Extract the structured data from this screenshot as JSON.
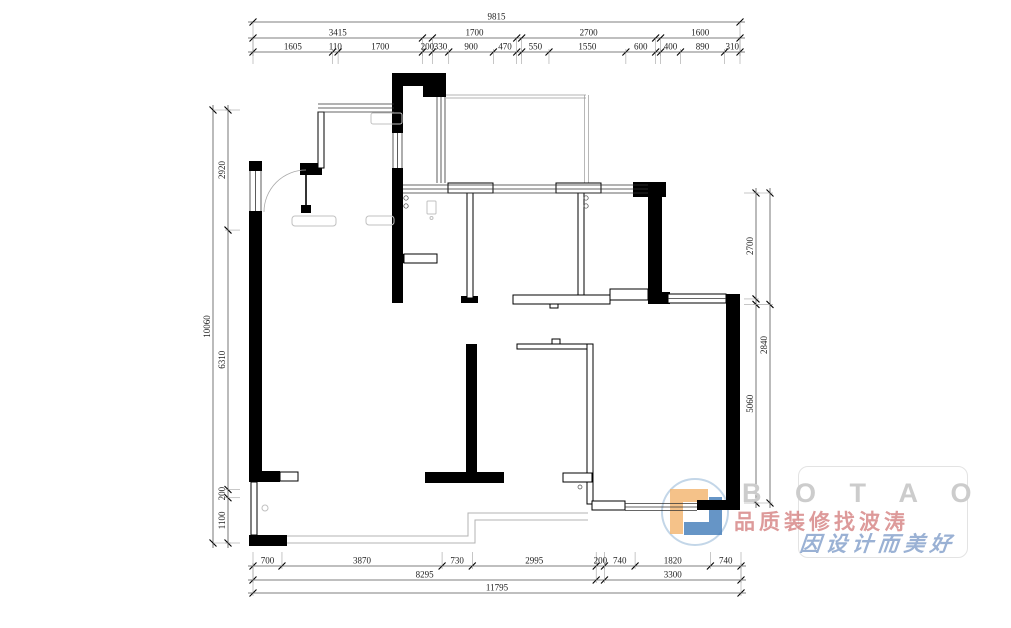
{
  "dimensions": {
    "top": {
      "overall": [
        9815
      ],
      "groups": [
        3415,
        200,
        1700,
        100,
        2700,
        100,
        1600
      ],
      "detail": [
        1605,
        110,
        1700,
        200,
        330,
        900,
        470,
        100,
        550,
        1550,
        600,
        100,
        400,
        890,
        310
      ]
    },
    "bottom": {
      "detail": [
        700,
        3870,
        730,
        2995,
        200,
        740,
        1820,
        740
      ],
      "groups": [
        8295,
        200,
        3300
      ],
      "overall": [
        11795
      ]
    },
    "left": {
      "overall": [
        10060
      ],
      "detail": [
        2920,
        6310,
        200,
        1100
      ]
    },
    "right": {
      "inner": [
        2700,
        140,
        5060
      ],
      "outer": [
        2840,
        5060
      ]
    }
  },
  "watermark": {
    "brand": "B O T A O",
    "line1": "品质装修找波涛",
    "line2": "因设计而美好",
    "brand_color": "#cccccc",
    "line1_color": "#d27878",
    "line2_color": "#7d9bc8",
    "logo_orange": "#f0a653",
    "logo_blue": "#2b6cb0",
    "logo_ring": "#b9d0e4"
  }
}
